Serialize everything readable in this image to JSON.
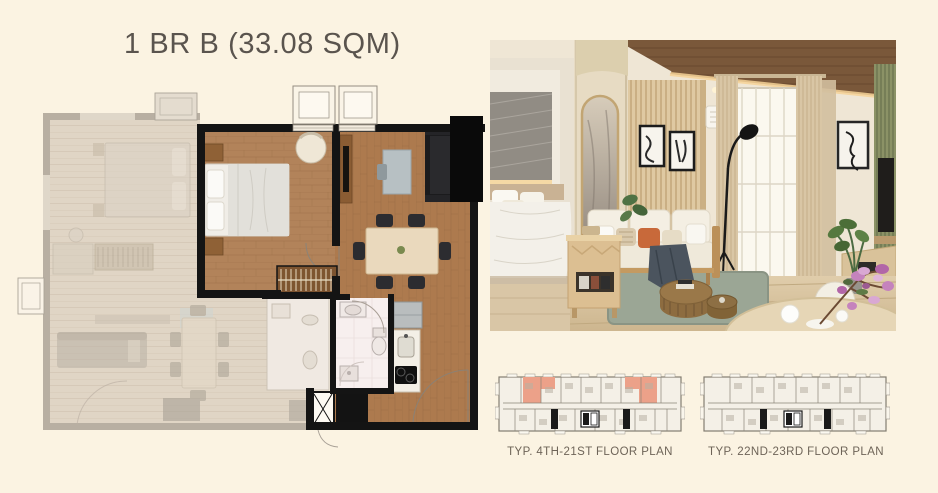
{
  "title": "1 BR B (33.08 SQM)",
  "plates": [
    {
      "label": "TYP. 4TH-21ST FLOOR PLAN",
      "has_highlight": true,
      "highlighted_units": 2
    },
    {
      "label": "TYP. 22ND-23RD FLOOR PLAN",
      "has_highlight": false,
      "highlighted_units": 0
    }
  ],
  "colors": {
    "background": "#fbf3e2",
    "title-text": "#5a544e",
    "caption-text": "#6e6458",
    "unit-highlight": "#eca189",
    "wood-floor": "#b2835a",
    "bold-wall": "#141414",
    "faded-wall": "#b1a89c"
  }
}
